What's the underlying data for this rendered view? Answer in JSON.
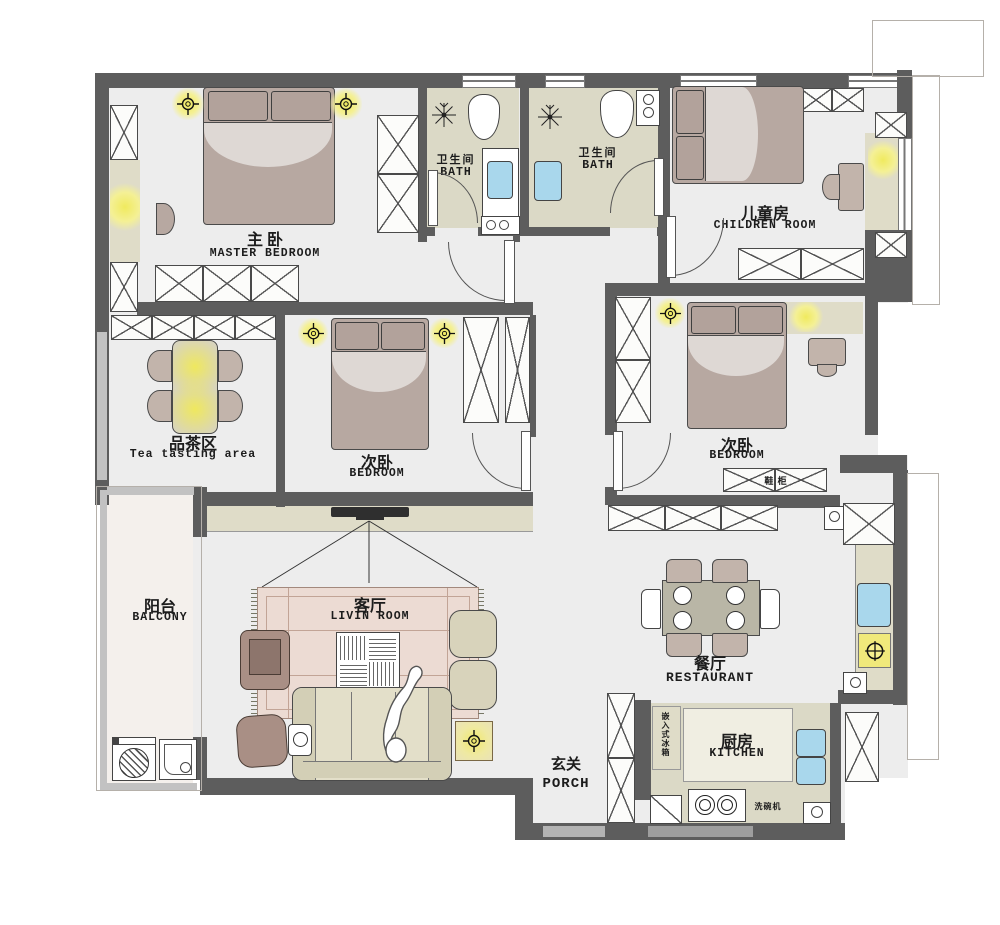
{
  "rooms": {
    "master": {
      "zh": "主  卧",
      "en": "MASTER BEDROOM"
    },
    "bath1": {
      "zh": "卫生间",
      "en": "BATH"
    },
    "bath2": {
      "zh": "卫生间",
      "en": "BATH"
    },
    "children": {
      "zh": "儿童房",
      "en": "CHILDREN ROOM"
    },
    "tea": {
      "zh": "品茶区",
      "en": "Tea tasting area"
    },
    "bedroom2": {
      "zh": "次卧",
      "en": "BEDROOM"
    },
    "bedroom3": {
      "zh": "次卧",
      "en": "BEDROOM"
    },
    "balcony": {
      "zh": "阳台",
      "en": "BALCONY"
    },
    "living": {
      "zh": "客厅",
      "en": "LIVIN ROOM"
    },
    "dining": {
      "zh": "餐厅",
      "en": "RESTAURANT"
    },
    "porch": {
      "zh": "玄关",
      "en": "PORCH"
    },
    "kitchen": {
      "zh": "厨房",
      "en": "KITCHEN"
    }
  },
  "annotations": {
    "shoe_cabinet": "鞋 柜",
    "fridge": "嵌入式冰箱",
    "dishwasher": "洗碗机"
  },
  "colors": {
    "wall": "#5d5d5d",
    "floor": "#ededed",
    "tile": "#dbd9c6",
    "counter": "#dfdcc8",
    "wood": "#b7a8a1",
    "rug": "#ecdbd3",
    "glow": "#f0ea5e",
    "sink_blue": "#a9d7ec"
  }
}
